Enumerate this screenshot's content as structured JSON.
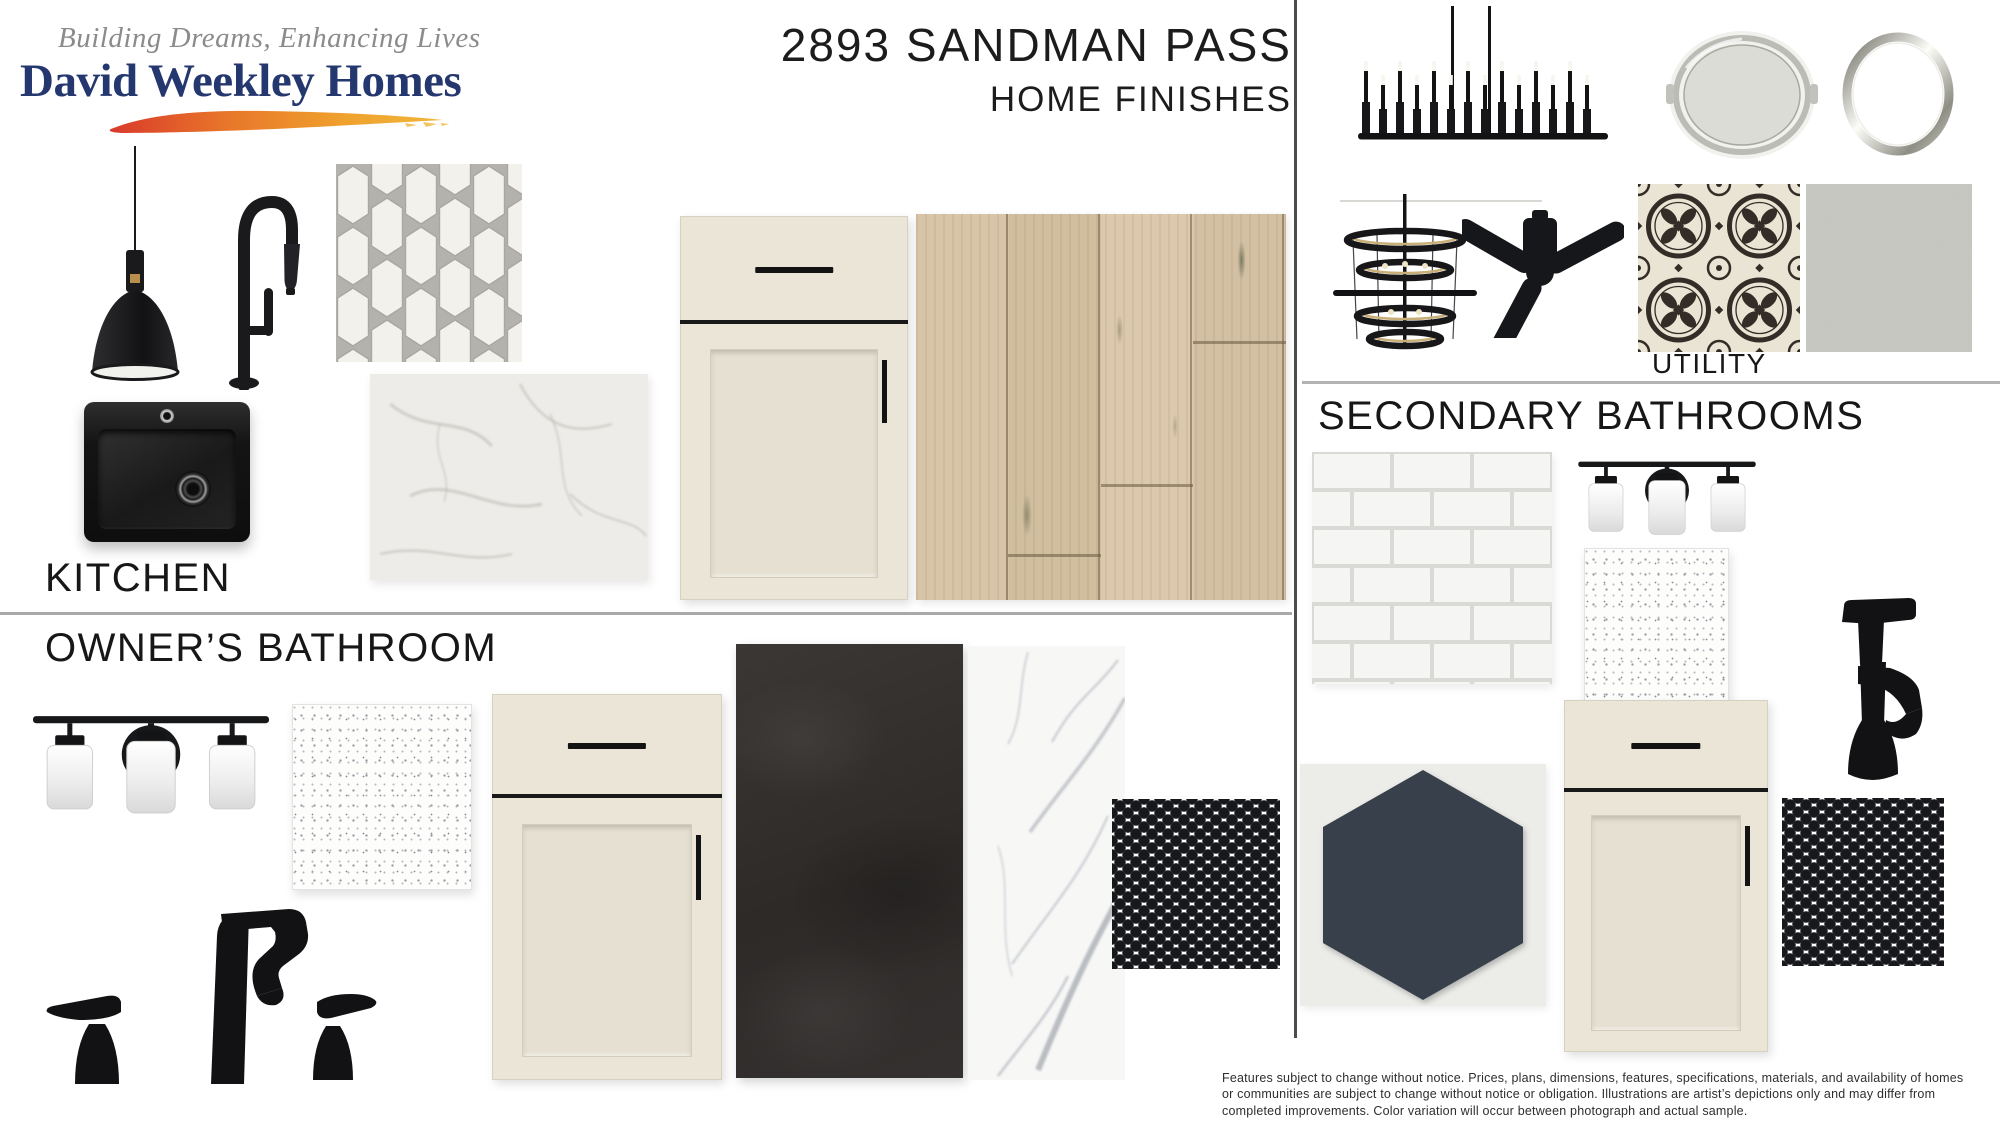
{
  "header": {
    "tagline": "Building Dreams, Enhancing Lives",
    "brand": "David Weekley Homes",
    "title": "2893 SANDMAN PASS",
    "subtitle": "HOME FINISHES"
  },
  "sections": {
    "kitchen": {
      "label": "KITCHEN"
    },
    "owners_bathroom": {
      "label": "OWNER’S BATHROOM"
    },
    "utility": {
      "label": "UTILITY"
    },
    "secondary_bathrooms": {
      "label": "SECONDARY BATHROOMS"
    }
  },
  "disclaimer": {
    "text": "Features subject to change without notice. Prices, plans, dimensions, features, specifications, materials, and availability of homes or communities are subject to change without notice or obligation.  Illustrations are artist’s depictions only and may differ from completed improvements.  Color variation will occur between photograph and actual sample."
  },
  "colors": {
    "brand_navy": "#24376e",
    "tagline_gray": "#8b8b8b",
    "fixture_black": "#1a1a1c",
    "cabinet_cream": "#eae5d7",
    "wood_oak": "#d5c2a4",
    "charcoal_tile": "#33302e",
    "hex_tile_slate": "#39404b",
    "paint_swatch_gray": "#dadcd5",
    "marble_white": "#f2f1ee",
    "penny_black": "#17181b",
    "divider_gray": "#a9a9a7"
  }
}
